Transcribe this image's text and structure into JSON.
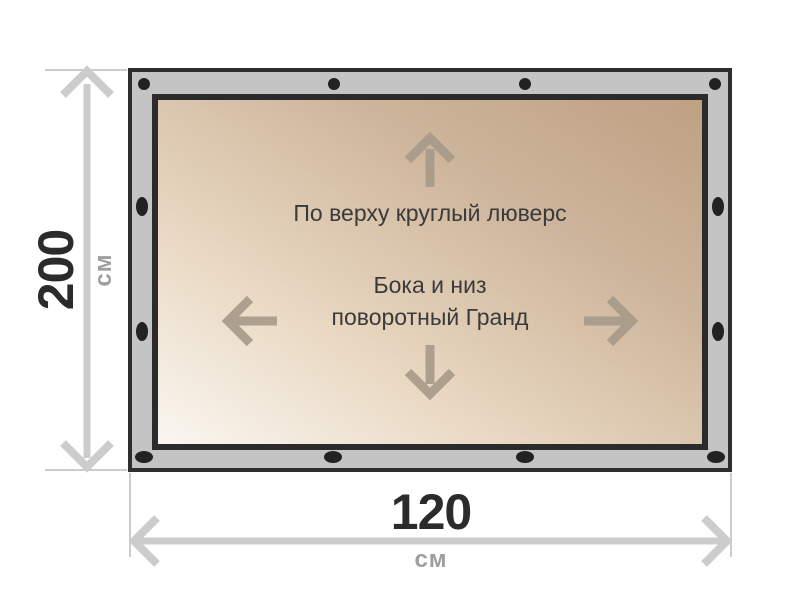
{
  "title": "Banner grommet layout diagram",
  "banner": {
    "top_note": "По верху круглый люверс",
    "middle_note_line1": "Бока и низ",
    "middle_note_line2": "поворотный Гранд"
  },
  "dimensions": {
    "height": {
      "value": "200",
      "unit": "см"
    },
    "width": {
      "value": "120",
      "unit": "см"
    }
  },
  "grommets": {
    "top_shape": "round",
    "side_and_bottom_shape": "oval",
    "count_top": 4,
    "count_bottom": 4,
    "count_left": 2,
    "count_right": 2
  },
  "icons": {
    "up": "arrow-up-icon",
    "down": "arrow-down-icon",
    "left": "arrow-left-icon",
    "right": "arrow-right-icon"
  },
  "colors": {
    "frame_gray": "#c4c4c4",
    "frame_border": "#2e2e2e",
    "grommet_black": "#222222",
    "banner_gradient_start": "#faf7f1",
    "banner_gradient_end": "#bfa083",
    "banner_text": "#3a3a3a",
    "inner_arrow": "#a79a89",
    "dimension_gray": "#cccccc",
    "dimension_value_text": "#2b2b2b",
    "dimension_unit_text": "#9e9e9e"
  }
}
